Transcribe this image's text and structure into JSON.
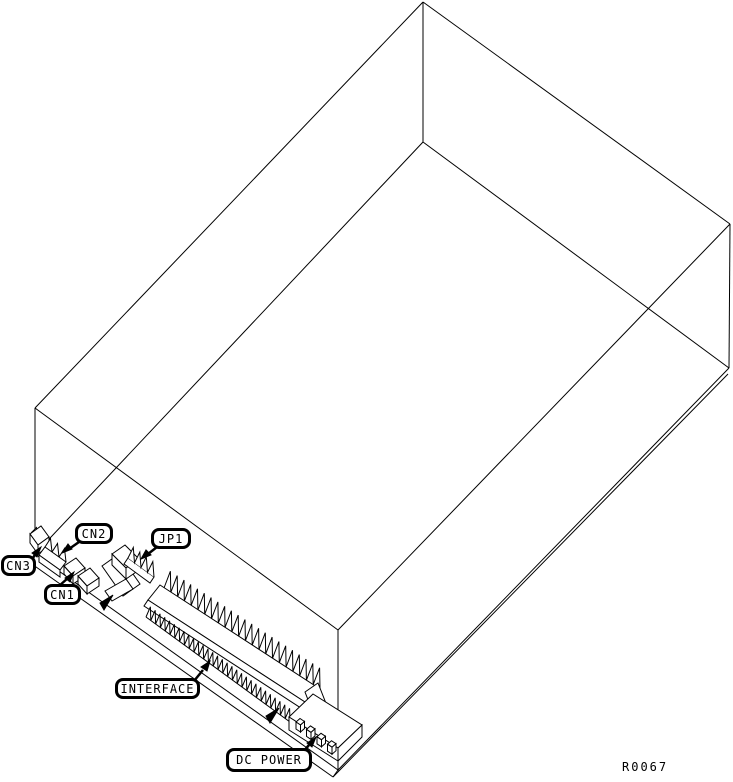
{
  "figure": {
    "ref_number": "R0067"
  },
  "colors": {
    "line": "#000000",
    "background": "#ffffff"
  },
  "callouts": {
    "cn3": "CN3",
    "cn2": "CN2",
    "cn1": "CN1",
    "jp1": "JP1",
    "interface": "INTERFACE",
    "dc_power": "DC POWER"
  }
}
